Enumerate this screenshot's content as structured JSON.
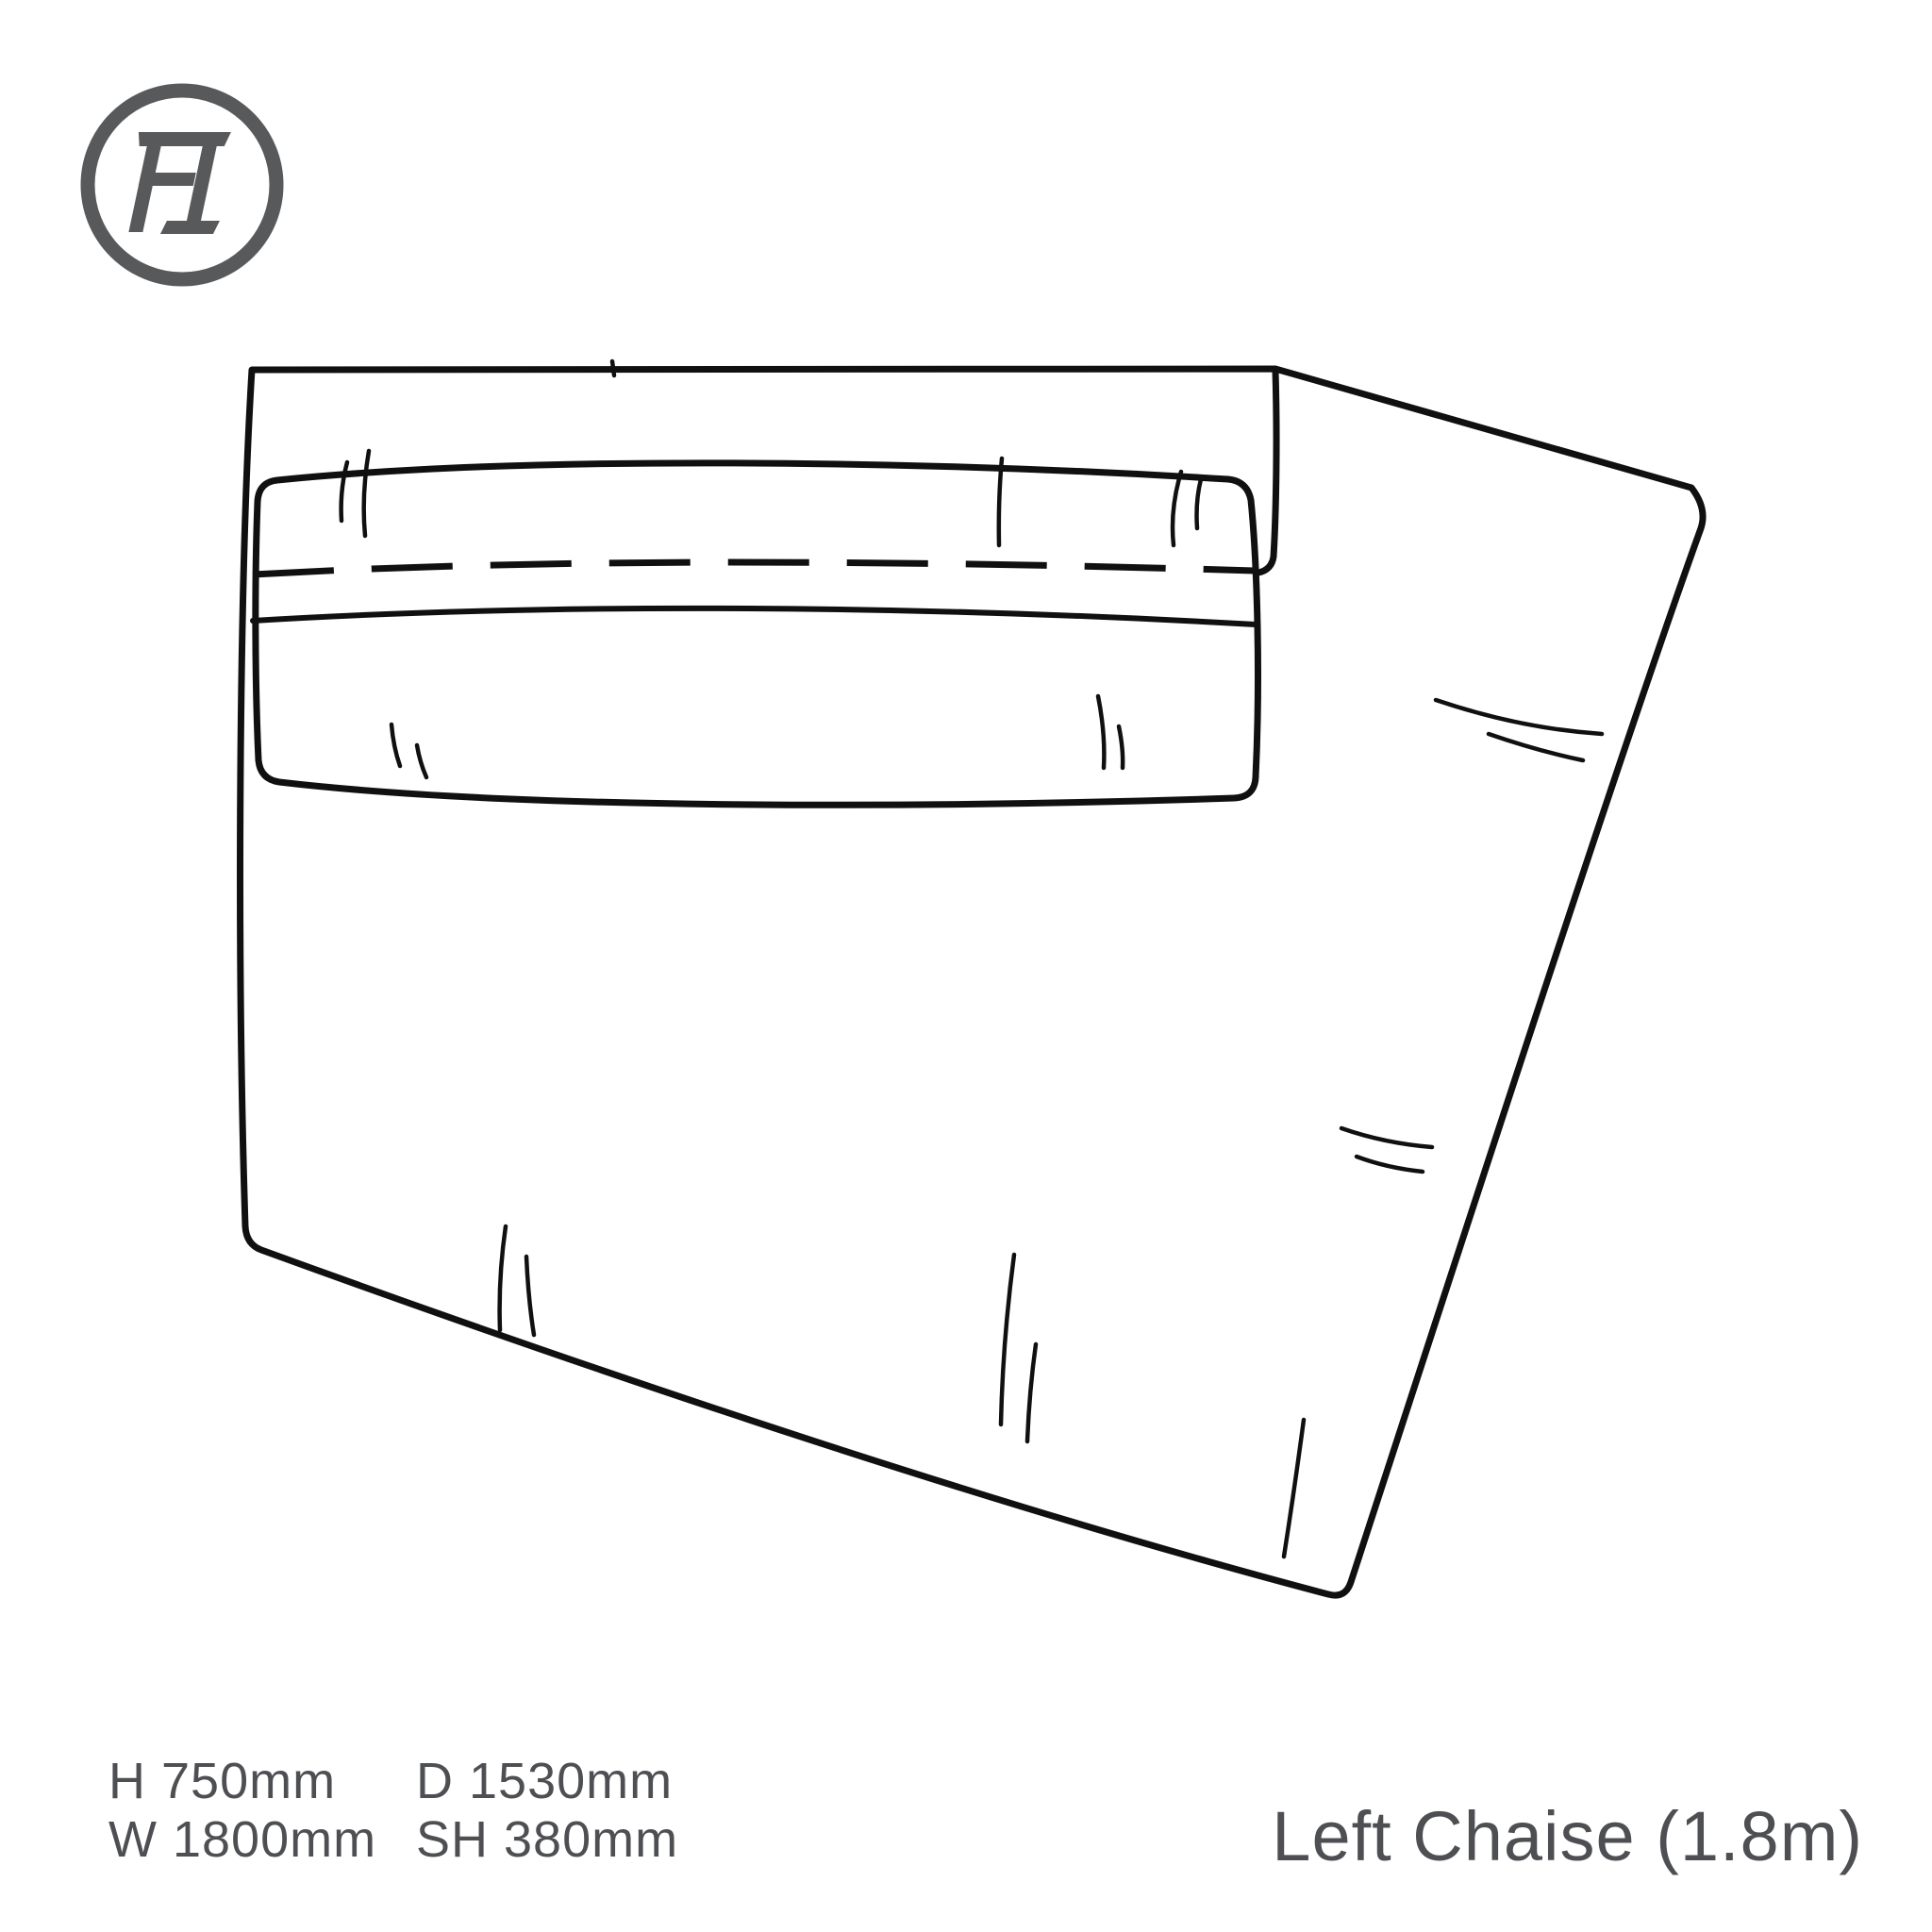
{
  "logo": {
    "monogram": "FI"
  },
  "specs": {
    "height": "H 750mm",
    "width": "W 1800mm",
    "depth": "D 1530mm",
    "seat_height": "SH 380mm"
  },
  "product": {
    "title": "Left Chaise (1.8m)"
  },
  "colors": {
    "line": "#101010",
    "text": "#4e4f53",
    "logo": "#58595b",
    "background": "#ffffff"
  }
}
